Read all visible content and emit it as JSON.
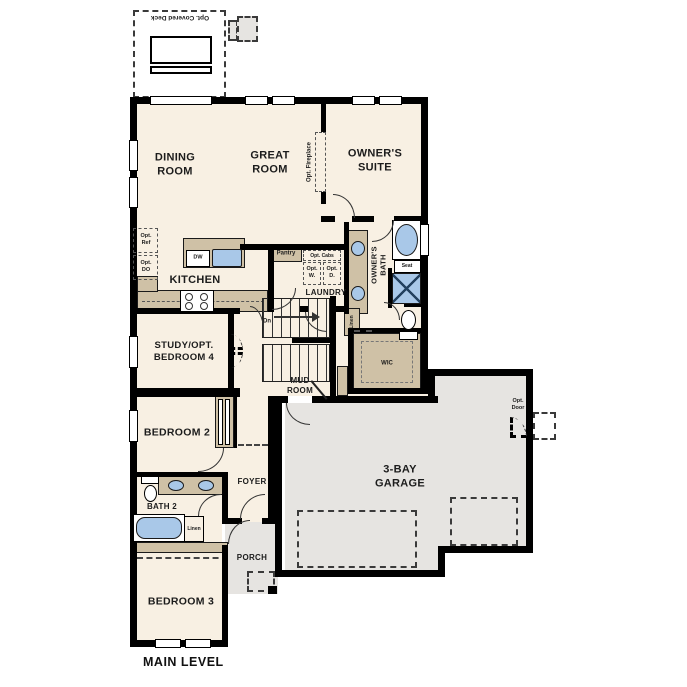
{
  "plan_title": "MAIN LEVEL",
  "rooms": {
    "deck": "Opt. Covered Deck",
    "dining": "DINING\nROOM",
    "great": "GREAT\nROOM",
    "owners_suite": "OWNER'S\nSUITE",
    "kitchen": "KITCHEN",
    "pantry": "Pantry",
    "laundry": "LAUNDRY",
    "owners_bath": "OWNER'S\nBATH",
    "wic": "WIC",
    "study": "STUDY/OPT.\nBEDROOM 4",
    "mud_room": "MUD\nROOM",
    "bedroom2": "BEDROOM 2",
    "foyer": "FOYER",
    "bath2": "BATH 2",
    "bedroom3": "BEDROOM 3",
    "porch": "PORCH",
    "garage": "3-BAY\nGARAGE"
  },
  "annotations": {
    "opt_fireplace": "Opt. Fireplace",
    "opt_ref": "Opt.\nRef",
    "opt_do": "Opt.\nDO",
    "dw": "DW",
    "opt_cabs": "Opt. Cabs",
    "opt_w": "Opt.\nW.",
    "opt_d": "Opt.\nD.",
    "seat": "Seat",
    "linen_owners": "Linen",
    "linen_bath2": "Linen",
    "stairs_dn": "Dn",
    "opt_door": "Opt.\nDoor"
  },
  "colors": {
    "wall": "#000000",
    "floor": "#f8f0e3",
    "exterior_area": "#e6e4e1",
    "cabinet": "#cfc1a6",
    "fixture": "#a9c8e8"
  }
}
